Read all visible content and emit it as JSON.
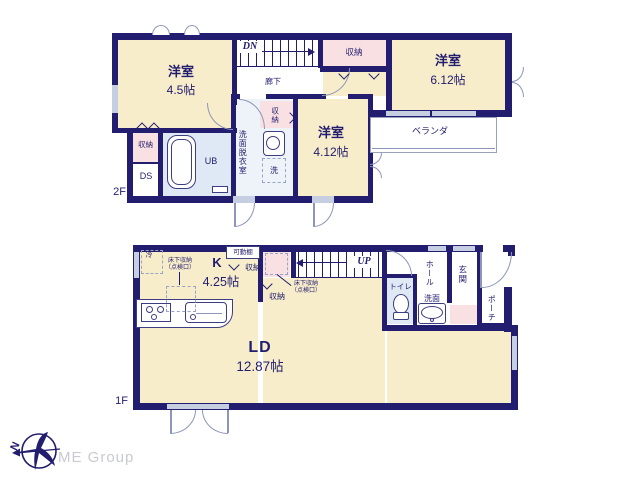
{
  "branding": {
    "company": "ME Group",
    "north": "N"
  },
  "f2": {
    "floor_label": "2F",
    "room_45": {
      "name": "洋室",
      "size": "4.5帖"
    },
    "stairs": "DN",
    "corridor": "廊下",
    "closet_hall": "収納",
    "room_612": {
      "name": "洋室",
      "size": "6.12帖"
    },
    "veranda": "ベランダ",
    "closet_west": "収納",
    "ds": "DS",
    "ub": "UB",
    "washroom": "洗面脱衣室",
    "closet_wash": "収納",
    "washer": "洗",
    "room_412": {
      "name": "洋室",
      "size": "4.12帖"
    }
  },
  "f1": {
    "floor_label": "1F",
    "fridge": "冷",
    "underfloor_kitchen": "床下収納\n（点検口）",
    "kitchen": {
      "name": "K",
      "size": "4.25帖"
    },
    "shelf": "可動棚",
    "closet_shelf": "収納",
    "closet_mid": "収納",
    "underfloor_mid": "床下収納\n（点検口）",
    "stairs": "UP",
    "toilet": "トイレ",
    "washbasin": "洗面",
    "hall": "ホール",
    "entrance": "玄関",
    "porch": "ポーチ",
    "ld": {
      "name": "LD",
      "size": "12.87帖"
    }
  }
}
